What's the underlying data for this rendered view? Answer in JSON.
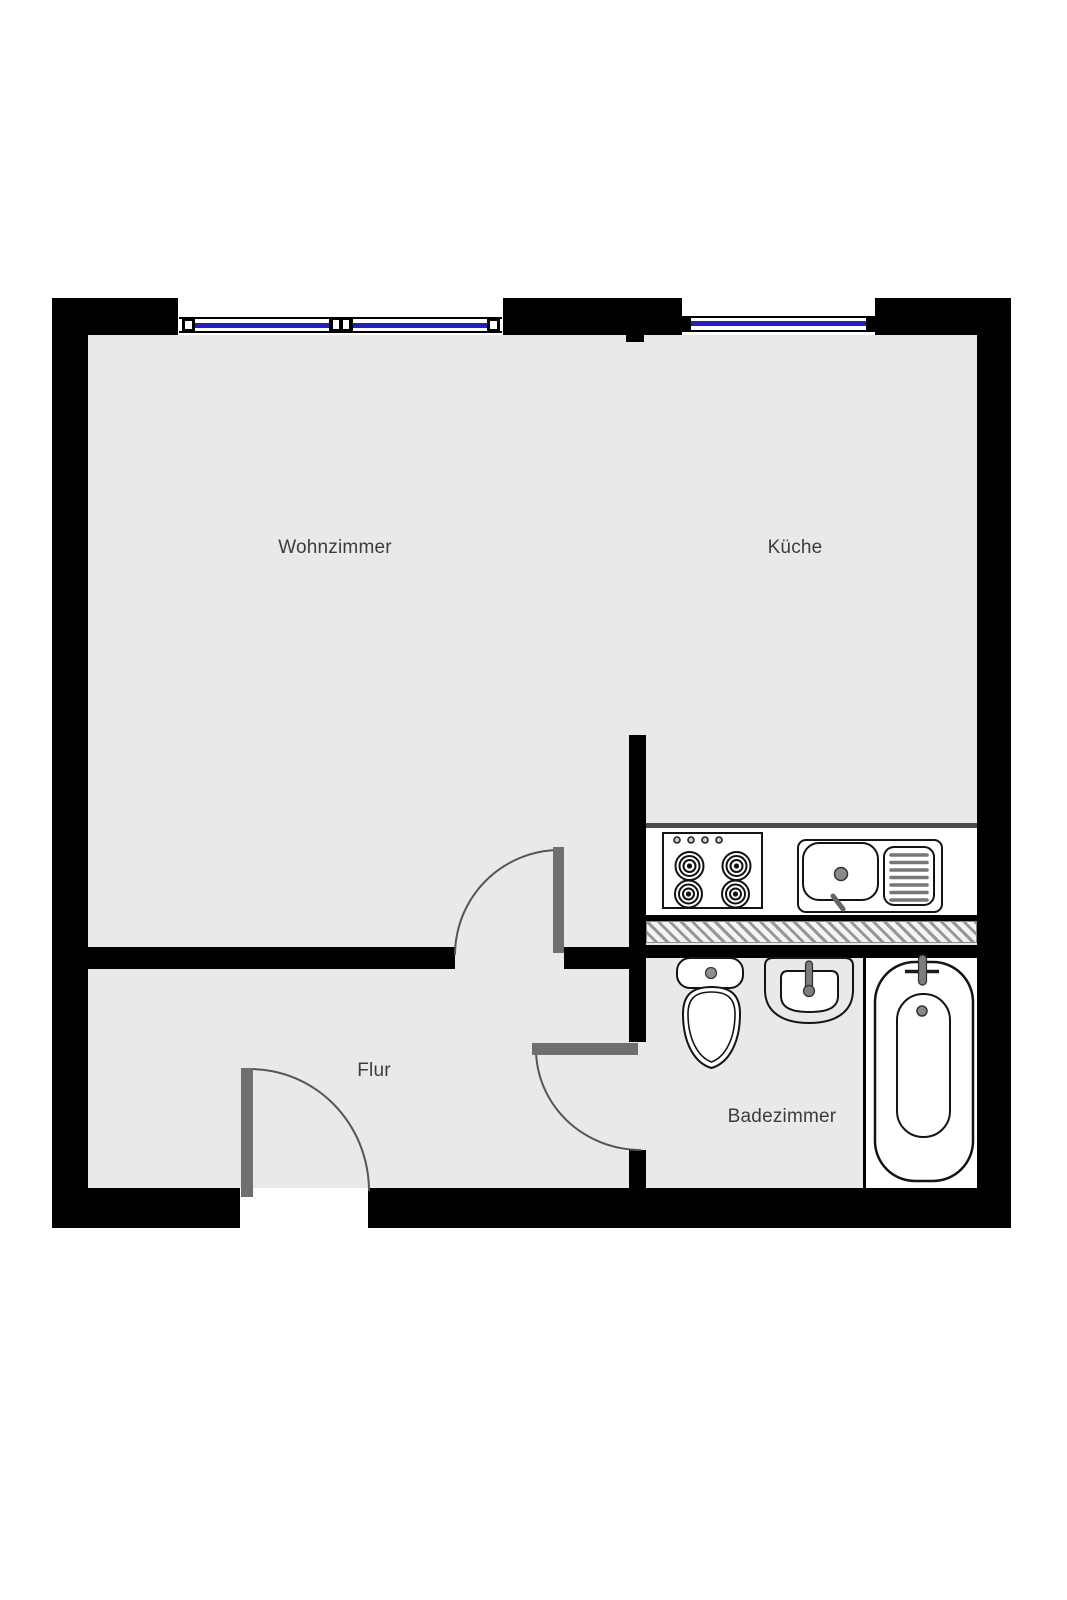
{
  "floorplan": {
    "rooms": [
      {
        "name": "wohnzimmer",
        "label": "Wohnzimmer"
      },
      {
        "name": "kueche",
        "label": "Küche"
      },
      {
        "name": "flur",
        "label": "Flur"
      },
      {
        "name": "badezimmer",
        "label": "Badezimmer"
      }
    ],
    "windows": [
      {
        "name": "window-living-room",
        "position": "top-left"
      },
      {
        "name": "window-kitchen",
        "position": "top-right"
      }
    ],
    "doors": [
      {
        "name": "door-living-room-to-hall"
      },
      {
        "name": "door-hall-to-bathroom"
      },
      {
        "name": "door-entrance"
      }
    ],
    "fixtures": [
      {
        "name": "stove",
        "room": "Küche"
      },
      {
        "name": "kitchen-sink",
        "room": "Küche"
      },
      {
        "name": "toilet",
        "room": "Badezimmer"
      },
      {
        "name": "washbasin",
        "room": "Badezimmer"
      },
      {
        "name": "bathtub",
        "room": "Badezimmer"
      }
    ],
    "colors": {
      "wall": "#000000",
      "floor": "#e9e9e9",
      "door_leaf": "#6f6f6f",
      "window_glass": "#1f1fce",
      "fixture_outline": "#141414",
      "hatch_line": "#979797",
      "label_text": "#3c3c3c"
    }
  }
}
